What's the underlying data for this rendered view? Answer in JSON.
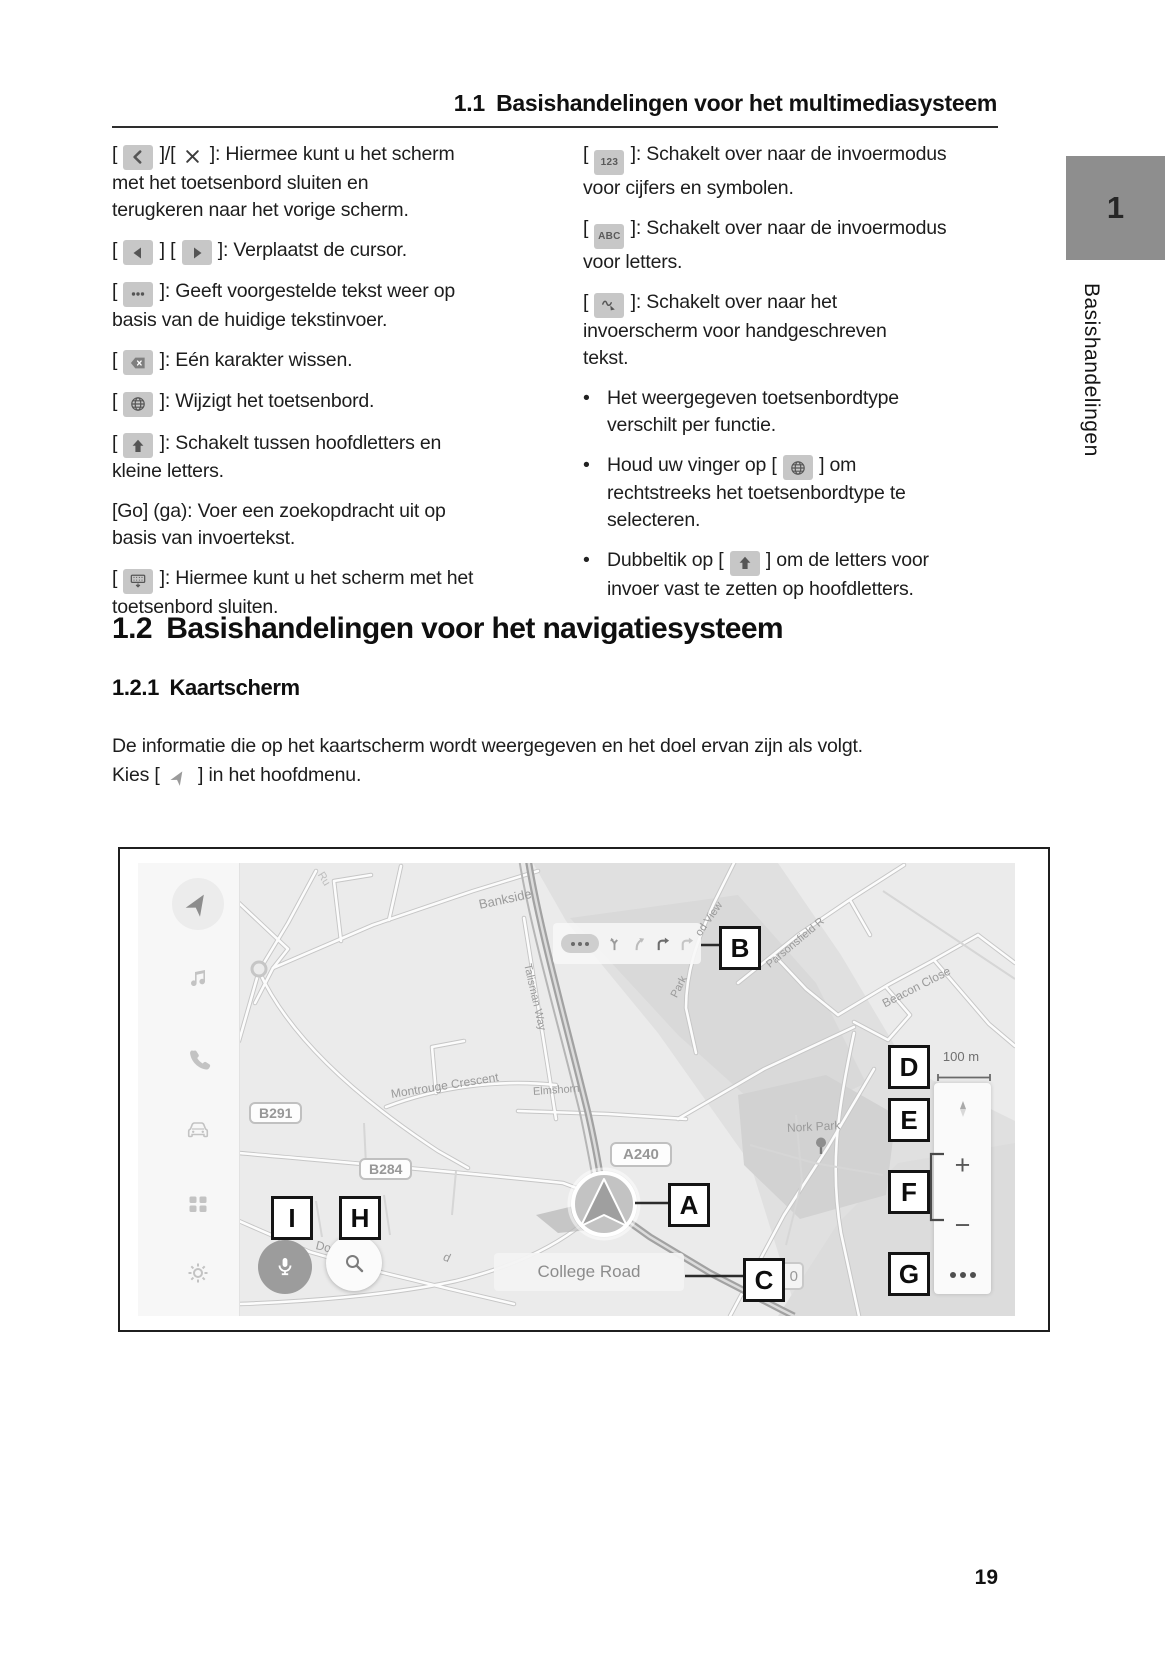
{
  "header": {
    "title": "1.1 Basishandelingen voor het multimediasysteem"
  },
  "side_tab": {
    "number": "1",
    "label": "Basishandelingen"
  },
  "multimedia": {
    "left_items": [
      {
        "parts": [
          {
            "t": "text",
            "v": "[ "
          },
          {
            "t": "icon",
            "v": "back-icon"
          },
          {
            "t": "text",
            "v": " ]/[ "
          },
          {
            "t": "icon",
            "v": "close-icon"
          },
          {
            "t": "text",
            "v": " ]: Hiermee kunt u het scherm"
          },
          {
            "t": "br"
          },
          {
            "t": "text",
            "v": "met het toetsenbord sluiten en"
          },
          {
            "t": "br"
          },
          {
            "t": "text",
            "v": "terugkeren naar het vorige scherm."
          }
        ]
      },
      {
        "parts": [
          {
            "t": "text",
            "v": "[ "
          },
          {
            "t": "icon",
            "v": "cursor-left-icon"
          },
          {
            "t": "text",
            "v": " ] [ "
          },
          {
            "t": "icon",
            "v": "cursor-right-icon"
          },
          {
            "t": "text",
            "v": " ]: Verplaatst de cursor."
          }
        ]
      },
      {
        "parts": [
          {
            "t": "text",
            "v": "[ "
          },
          {
            "t": "icon",
            "v": "suggest-icon"
          },
          {
            "t": "text",
            "v": " ]: Geeft voorgestelde tekst weer op"
          },
          {
            "t": "br"
          },
          {
            "t": "text",
            "v": "basis van de huidige tekstinvoer."
          }
        ]
      },
      {
        "parts": [
          {
            "t": "text",
            "v": "[ "
          },
          {
            "t": "icon",
            "v": "backspace-icon"
          },
          {
            "t": "text",
            "v": " ]: Eén karakter wissen."
          }
        ]
      },
      {
        "parts": [
          {
            "t": "text",
            "v": "[ "
          },
          {
            "t": "icon",
            "v": "globe-icon"
          },
          {
            "t": "text",
            "v": " ]: Wijzigt het toetsenbord."
          }
        ]
      },
      {
        "parts": [
          {
            "t": "text",
            "v": "[ "
          },
          {
            "t": "icon",
            "v": "shift-icon"
          },
          {
            "t": "text",
            "v": " ]: Schakelt tussen hoofdletters en"
          },
          {
            "t": "br"
          },
          {
            "t": "text",
            "v": "kleine letters."
          }
        ]
      },
      {
        "parts": [
          {
            "t": "text",
            "v": "[Go] (ga): Voer een zoekopdracht uit op"
          },
          {
            "t": "br"
          },
          {
            "t": "text",
            "v": "basis van invoertekst."
          }
        ]
      },
      {
        "parts": [
          {
            "t": "text",
            "v": "[ "
          },
          {
            "t": "icon",
            "v": "keyboard-close-icon"
          },
          {
            "t": "text",
            "v": " ]: Hiermee kunt u het scherm met het"
          },
          {
            "t": "br"
          },
          {
            "t": "text",
            "v": "toetsenbord sluiten."
          }
        ]
      }
    ],
    "right_items": [
      {
        "parts": [
          {
            "t": "text",
            "v": "[ "
          },
          {
            "t": "icon",
            "v": "numbers-123-icon"
          },
          {
            "t": "text",
            "v": " ]: Schakelt over naar de invoermodus"
          },
          {
            "t": "br"
          },
          {
            "t": "text",
            "v": "voor cijfers en symbolen."
          }
        ]
      },
      {
        "parts": [
          {
            "t": "text",
            "v": "[ "
          },
          {
            "t": "icon",
            "v": "letters-abc-icon"
          },
          {
            "t": "text",
            "v": " ]: Schakelt over naar de invoermodus"
          },
          {
            "t": "br"
          },
          {
            "t": "text",
            "v": "voor letters."
          }
        ]
      },
      {
        "parts": [
          {
            "t": "text",
            "v": "[ "
          },
          {
            "t": "icon",
            "v": "handwriting-icon"
          },
          {
            "t": "text",
            "v": " ]: Schakelt over naar het"
          },
          {
            "t": "br"
          },
          {
            "t": "text",
            "v": "invoerscherm voor handgeschreven"
          },
          {
            "t": "br"
          },
          {
            "t": "text",
            "v": "tekst."
          }
        ]
      }
    ],
    "bullets": [
      {
        "parts": [
          {
            "t": "text",
            "v": "Het weergegeven toetsenbordtype"
          },
          {
            "t": "br"
          },
          {
            "t": "text",
            "v": "verschilt per functie."
          }
        ]
      },
      {
        "parts": [
          {
            "t": "text",
            "v": "Houd uw vinger op [ "
          },
          {
            "t": "icon",
            "v": "globe-icon"
          },
          {
            "t": "text",
            "v": " ] om"
          },
          {
            "t": "br"
          },
          {
            "t": "text",
            "v": "rechtstreeks het toetsenbordtype te"
          },
          {
            "t": "br"
          },
          {
            "t": "text",
            "v": "selecteren."
          }
        ]
      },
      {
        "parts": [
          {
            "t": "text",
            "v": "Dubbeltik op [ "
          },
          {
            "t": "icon",
            "v": "shift-icon"
          },
          {
            "t": "text",
            "v": " ] om de letters voor"
          },
          {
            "t": "br"
          },
          {
            "t": "text",
            "v": "invoer vast te zetten op hoofdletters."
          }
        ]
      }
    ]
  },
  "navigation": {
    "heading": "1.2 Basishandelingen voor het navigatiesysteem",
    "subheading": "1.2.1 Kaartscherm",
    "intro": {
      "parts": [
        {
          "t": "text",
          "v": "De informatie die op het kaartscherm wordt weergegeven en het doel ervan zijn als volgt."
        },
        {
          "t": "br"
        },
        {
          "t": "text",
          "v": "Kies [ "
        },
        {
          "t": "icon",
          "v": "nav-arrow-icon"
        },
        {
          "t": "text",
          "v": " ] in het hoofdmenu."
        }
      ]
    }
  },
  "figure": {
    "sidebar_icons": [
      {
        "name": "nav-arrow-icon",
        "y": 41,
        "active": true
      },
      {
        "name": "music-icon",
        "y": 116
      },
      {
        "name": "phone-icon",
        "y": 196
      },
      {
        "name": "car-icon",
        "y": 268
      },
      {
        "name": "apps-icon",
        "y": 341
      },
      {
        "name": "settings-icon",
        "y": 410
      }
    ],
    "lane_icons": [
      {
        "name": "lane-fork-icon",
        "tone": "c1"
      },
      {
        "name": "lane-slight-right-icon",
        "tone": "c2"
      },
      {
        "name": "lane-turn-right-icon",
        "tone": "c3"
      },
      {
        "name": "lane-turn-right-dim-icon",
        "tone": "c4"
      }
    ],
    "labels": [
      {
        "text": "Ru",
        "x": 182,
        "y": 4,
        "rot": 58,
        "size": 11,
        "dim": true
      },
      {
        "text": "Bankside",
        "x": 341,
        "y": 34,
        "rot": -12,
        "size": 13
      },
      {
        "text": "od View",
        "x": 560,
        "y": 66,
        "rot": -55,
        "size": 11
      },
      {
        "text": "Park",
        "x": 536,
        "y": 128,
        "rot": -63,
        "size": 11
      },
      {
        "text": "Parsonsfield R",
        "x": 630,
        "y": 97,
        "rot": -40,
        "size": 11
      },
      {
        "text": "Beacon Close",
        "x": 745,
        "y": 134,
        "rot": -27,
        "size": 12
      },
      {
        "text": "Talisman Way",
        "x": 389,
        "y": 95,
        "rot": 77,
        "size": 11
      },
      {
        "text": "Montrouge Crescent",
        "x": 253,
        "y": 224,
        "rot": -9,
        "size": 12
      },
      {
        "text": "Elmshorn",
        "x": 395,
        "y": 223,
        "rot": -4,
        "size": 11
      },
      {
        "text": "Nork Park",
        "x": 649,
        "y": 258,
        "rot": -3,
        "size": 12
      },
      {
        "text": "Dow",
        "x": 178,
        "y": 375,
        "rot": 13,
        "size": 12
      },
      {
        "text": "d",
        "x": 306,
        "y": 386,
        "rot": 25,
        "size": 12
      }
    ],
    "shields": [
      {
        "text": "B291",
        "x": 111,
        "y": 239
      },
      {
        "text": "B284",
        "x": 221,
        "y": 295
      },
      {
        "text": "A240",
        "x": 472,
        "y": 279,
        "big": true
      }
    ],
    "callouts": [
      {
        "letter": "A",
        "x": 530,
        "y": 320
      },
      {
        "letter": "B",
        "x": 581,
        "y": 63
      },
      {
        "letter": "C",
        "x": 605,
        "y": 395
      },
      {
        "letter": "D",
        "x": 750,
        "y": 182
      },
      {
        "letter": "E",
        "x": 750,
        "y": 235
      },
      {
        "letter": "F",
        "x": 750,
        "y": 307
      },
      {
        "letter": "G",
        "x": 750,
        "y": 389
      },
      {
        "letter": "H",
        "x": 201,
        "y": 333
      },
      {
        "letter": "I",
        "x": 133,
        "y": 333
      }
    ],
    "scale_label": "100 m",
    "zoom_in": "+",
    "zoom_out": "−",
    "road_name": "College Road",
    "speed_badge": "0"
  },
  "footer": {
    "page_number": "19"
  }
}
